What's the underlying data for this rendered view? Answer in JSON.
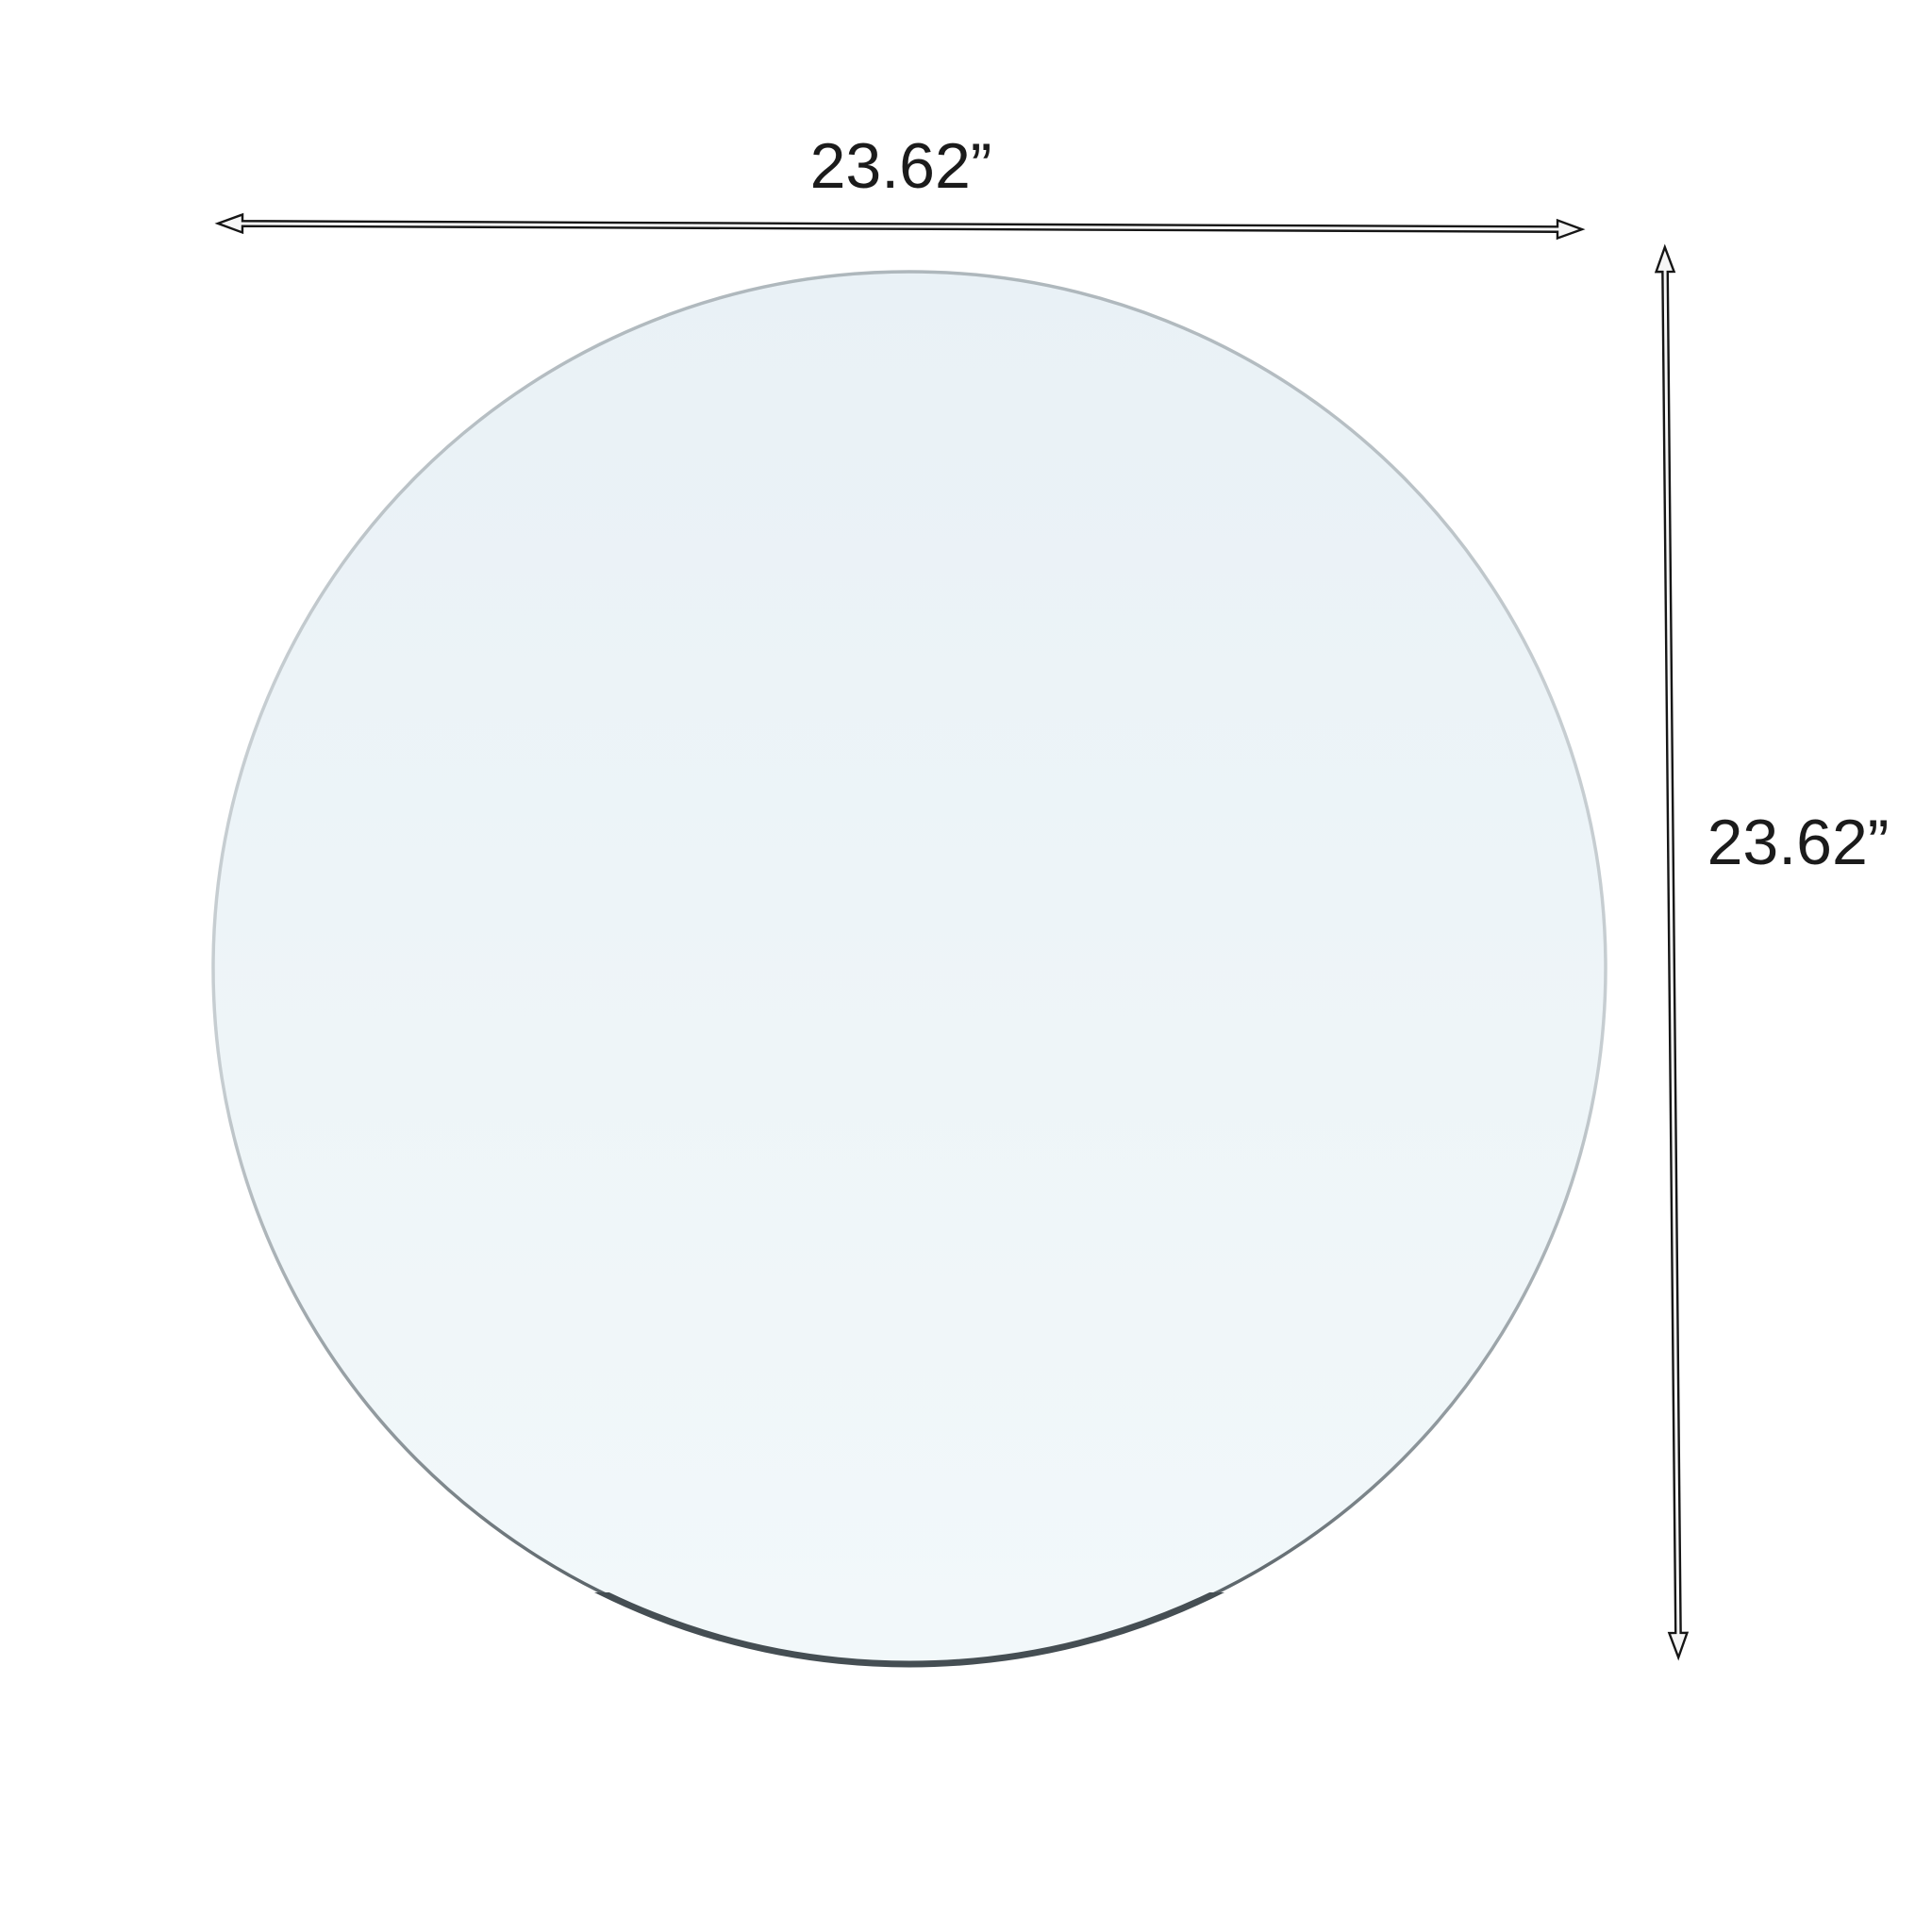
{
  "diagram": {
    "width_label": "23.62”",
    "height_label": "23.62”",
    "colors": {
      "background": "#ffffff",
      "label_text": "#1b1b1b",
      "glass_fill_top": "#e9f1f6",
      "glass_fill_bottom": "#f2f8fa",
      "glass_edge_top": "#aeb7bc",
      "glass_edge_light": "#c6cdd1",
      "glass_edge_mid": "#8d969b",
      "glass_edge_bottom": "#454e53",
      "arrow_fill": "#f6f6f6",
      "arrow_outline": "#161616"
    }
  }
}
